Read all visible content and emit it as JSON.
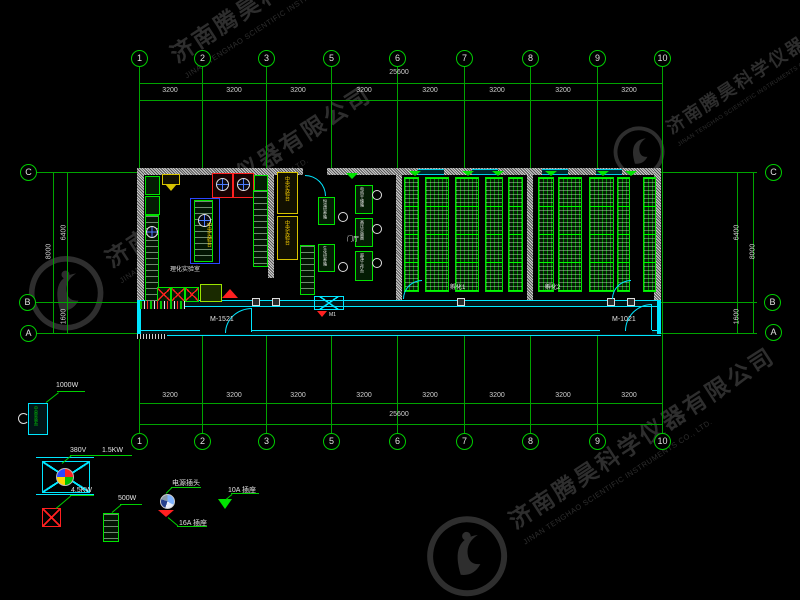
{
  "watermark": {
    "company_cn": "济南腾昊科学仪器有限公司",
    "company_en": "JINAN TENGHAO SCIENTIFIC INSTRUMENTS CO., LTD."
  },
  "grid": {
    "bubbles": [
      "1",
      "2",
      "3",
      "5",
      "6",
      "7",
      "8",
      "9",
      "10"
    ],
    "rows": [
      "C",
      "B",
      "A"
    ],
    "bay_dim": "3200",
    "total_dim": "25600",
    "side_upper": "6400",
    "side_lower": "1600",
    "side_total": "8000"
  },
  "rooms": {
    "lab": "理化实验室",
    "hall": "门厅",
    "hatch1": "孵化1",
    "hatch2": "孵化2"
  },
  "doors": {
    "m1521": "M-1521",
    "m1021": "M-1021",
    "m1": "M1"
  },
  "bench": {
    "central": "中央实验台"
  },
  "equipment": [
    "恒温培养箱",
    "生化培养箱",
    "电热干燥箱",
    "高压灭菌器",
    "超净工作台"
  ],
  "legend": {
    "cabinet": "中央实验台",
    "p1000": "1000W",
    "v380": "380V",
    "p15": "1.5KW",
    "p45": "4.5KW",
    "p500": "500W",
    "plug": "电源插头",
    "s16": "16A  插座",
    "s10": "10A  插座"
  },
  "colors": {
    "grid_green": "#00a400",
    "bright_green": "#00e400",
    "cyan": "#00e6ff",
    "red": "#ff2020",
    "yellow": "#ffd400",
    "blue": "#2a46ff",
    "dim_text": "#cfcfcf",
    "watermark": "#2e2e2e"
  }
}
